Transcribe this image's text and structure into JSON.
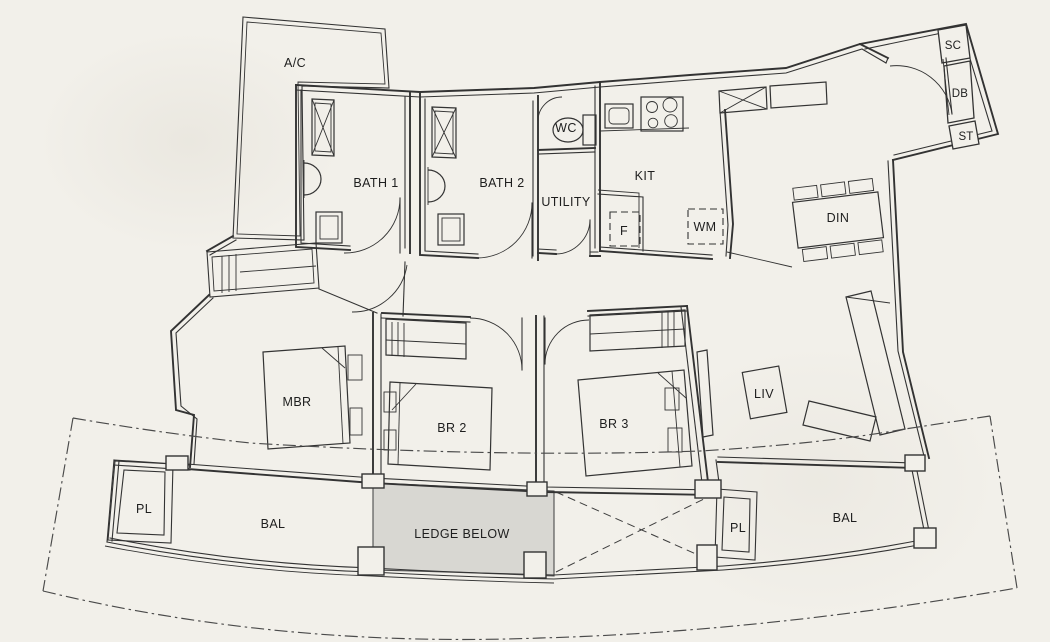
{
  "title": "Apartment Unit Floor Plan",
  "colors": {
    "paper": "#f2f0ea",
    "line": "#333333",
    "ledge_fill": "#d8d7d2",
    "text": "#1e1e1e"
  },
  "labels": {
    "ac": "A/C",
    "bath1": "BATH 1",
    "bath2": "BATH 2",
    "wc": "WC",
    "utility": "UTILITY",
    "kit": "KIT",
    "fridge": "F",
    "washing_machine": "WM",
    "shoe_cabinet": "SC",
    "db_box": "DB",
    "storage": "ST",
    "dining": "DIN",
    "master_bedroom": "MBR",
    "bedroom2": "BR 2",
    "bedroom3": "BR 3",
    "living": "LIV",
    "planter_left": "PL",
    "balcony_left": "BAL",
    "ledge_below": "LEDGE BELOW",
    "planter_right": "PL",
    "balcony_right": "BAL"
  }
}
